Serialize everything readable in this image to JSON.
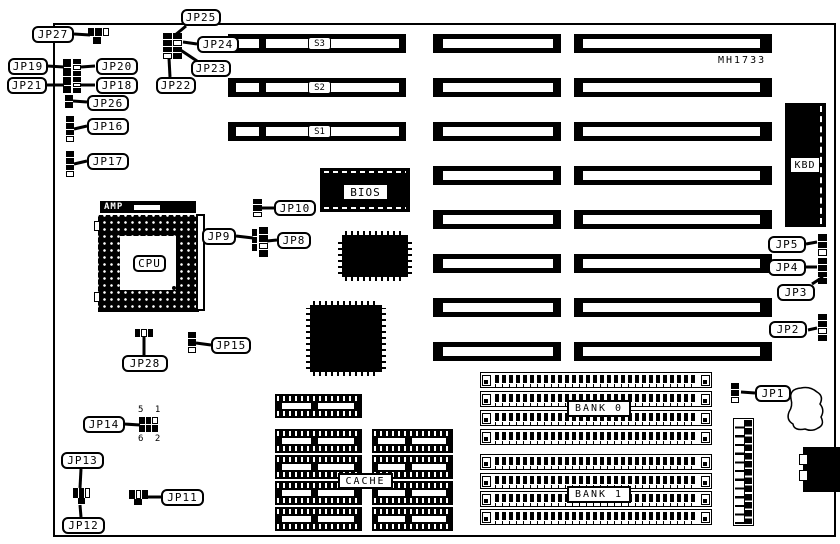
{
  "diagram": {
    "model": "MH1733",
    "labels": {
      "cpu": "CPU",
      "amp": "AMP",
      "bios": "BIOS",
      "cache": "CACHE",
      "kbd": "KBD",
      "bank0": "BANK 0",
      "bank1": "BANK 1",
      "s1": "S1",
      "s2": "S2",
      "s3": "S3",
      "jp14_pins_top": "5 1",
      "jp14_pins_bottom": "6 2"
    },
    "jumpers": {
      "jp1": "JP1",
      "jp2": "JP2",
      "jp3": "JP3",
      "jp4": "JP4",
      "jp5": "JP5",
      "jp8": "JP8",
      "jp9": "JP9",
      "jp10": "JP10",
      "jp11": "JP11",
      "jp12": "JP12",
      "jp13": "JP13",
      "jp14": "JP14",
      "jp15": "JP15",
      "jp16": "JP16",
      "jp17": "JP17",
      "jp18": "JP18",
      "jp19": "JP19",
      "jp20": "JP20",
      "jp21": "JP21",
      "jp22": "JP22",
      "jp23": "JP23",
      "jp24": "JP24",
      "jp25": "JP25",
      "jp26": "JP26",
      "jp27": "JP27",
      "jp28": "JP28"
    }
  }
}
